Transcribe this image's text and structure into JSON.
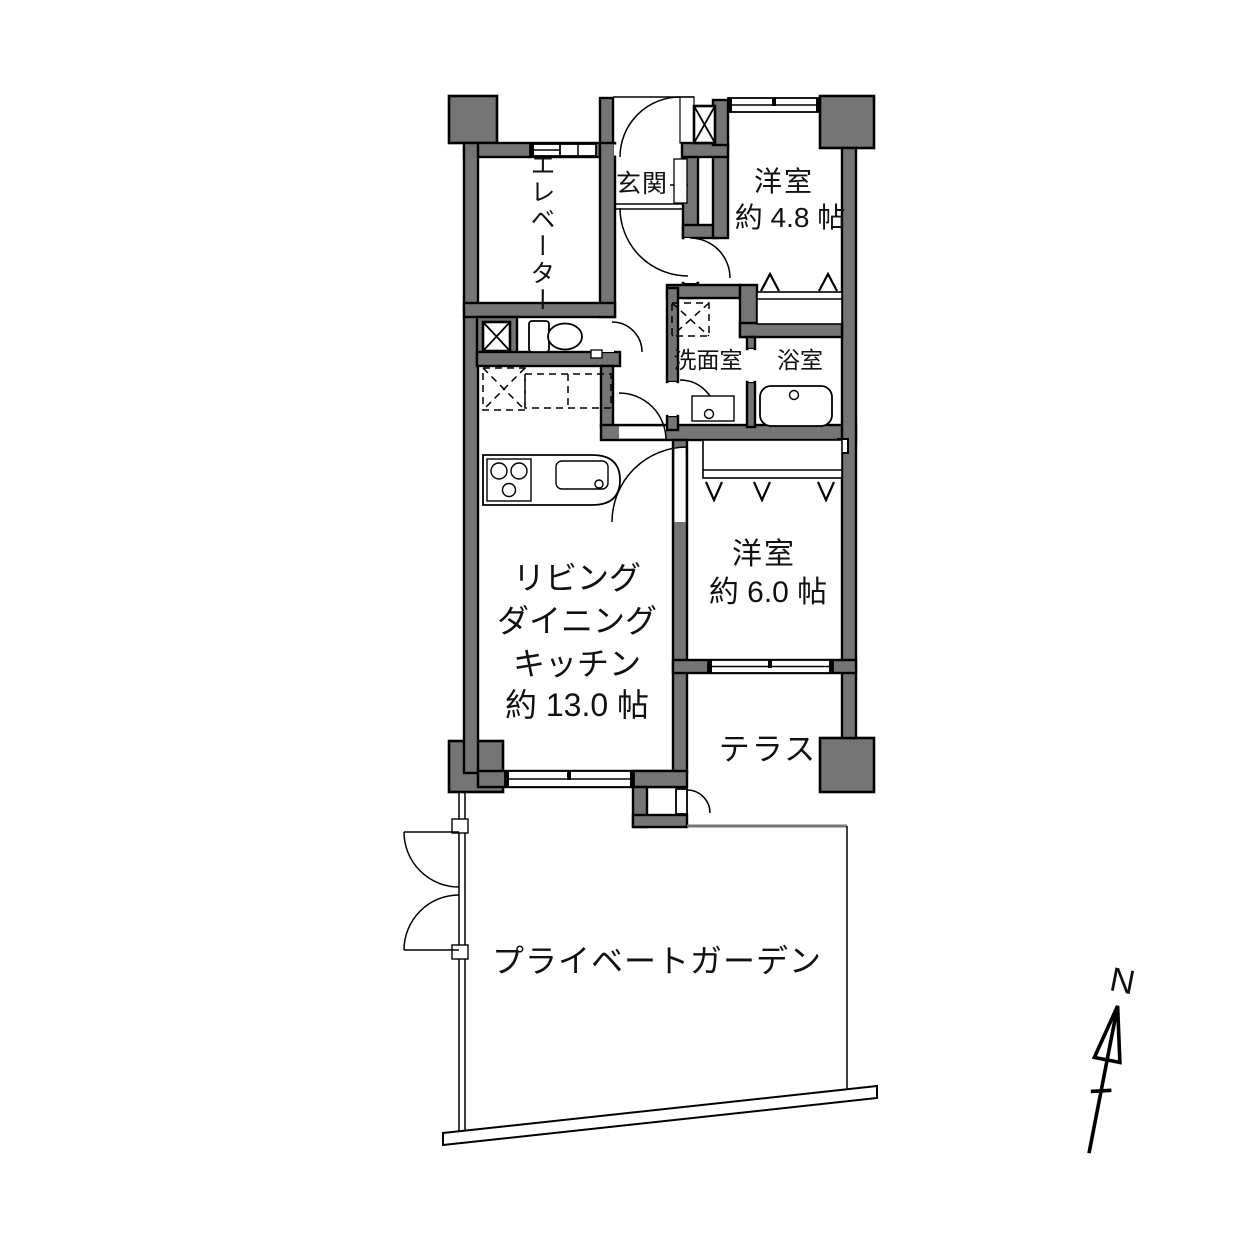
{
  "floorplan": {
    "labels": {
      "elevator": "エレベーター",
      "entrance": "玄関",
      "bedroom1_name": "洋室",
      "bedroom1_size": "約 4.8 帖",
      "washroom": "洗面室",
      "bathroom": "浴室",
      "ldk_line1": "リビング",
      "ldk_line2": "ダイニング",
      "ldk_line3": "キッチン",
      "ldk_size": "約 13.0 帖",
      "bedroom2_name": "洋室",
      "bedroom2_size": "約 6.0 帖",
      "terrace": "テラス",
      "garden": "プライベートガーデン"
    },
    "compass": {
      "north_label": "N"
    },
    "colors": {
      "wall_fill": "#757575",
      "line": "#000000",
      "background": "#ffffff"
    }
  }
}
